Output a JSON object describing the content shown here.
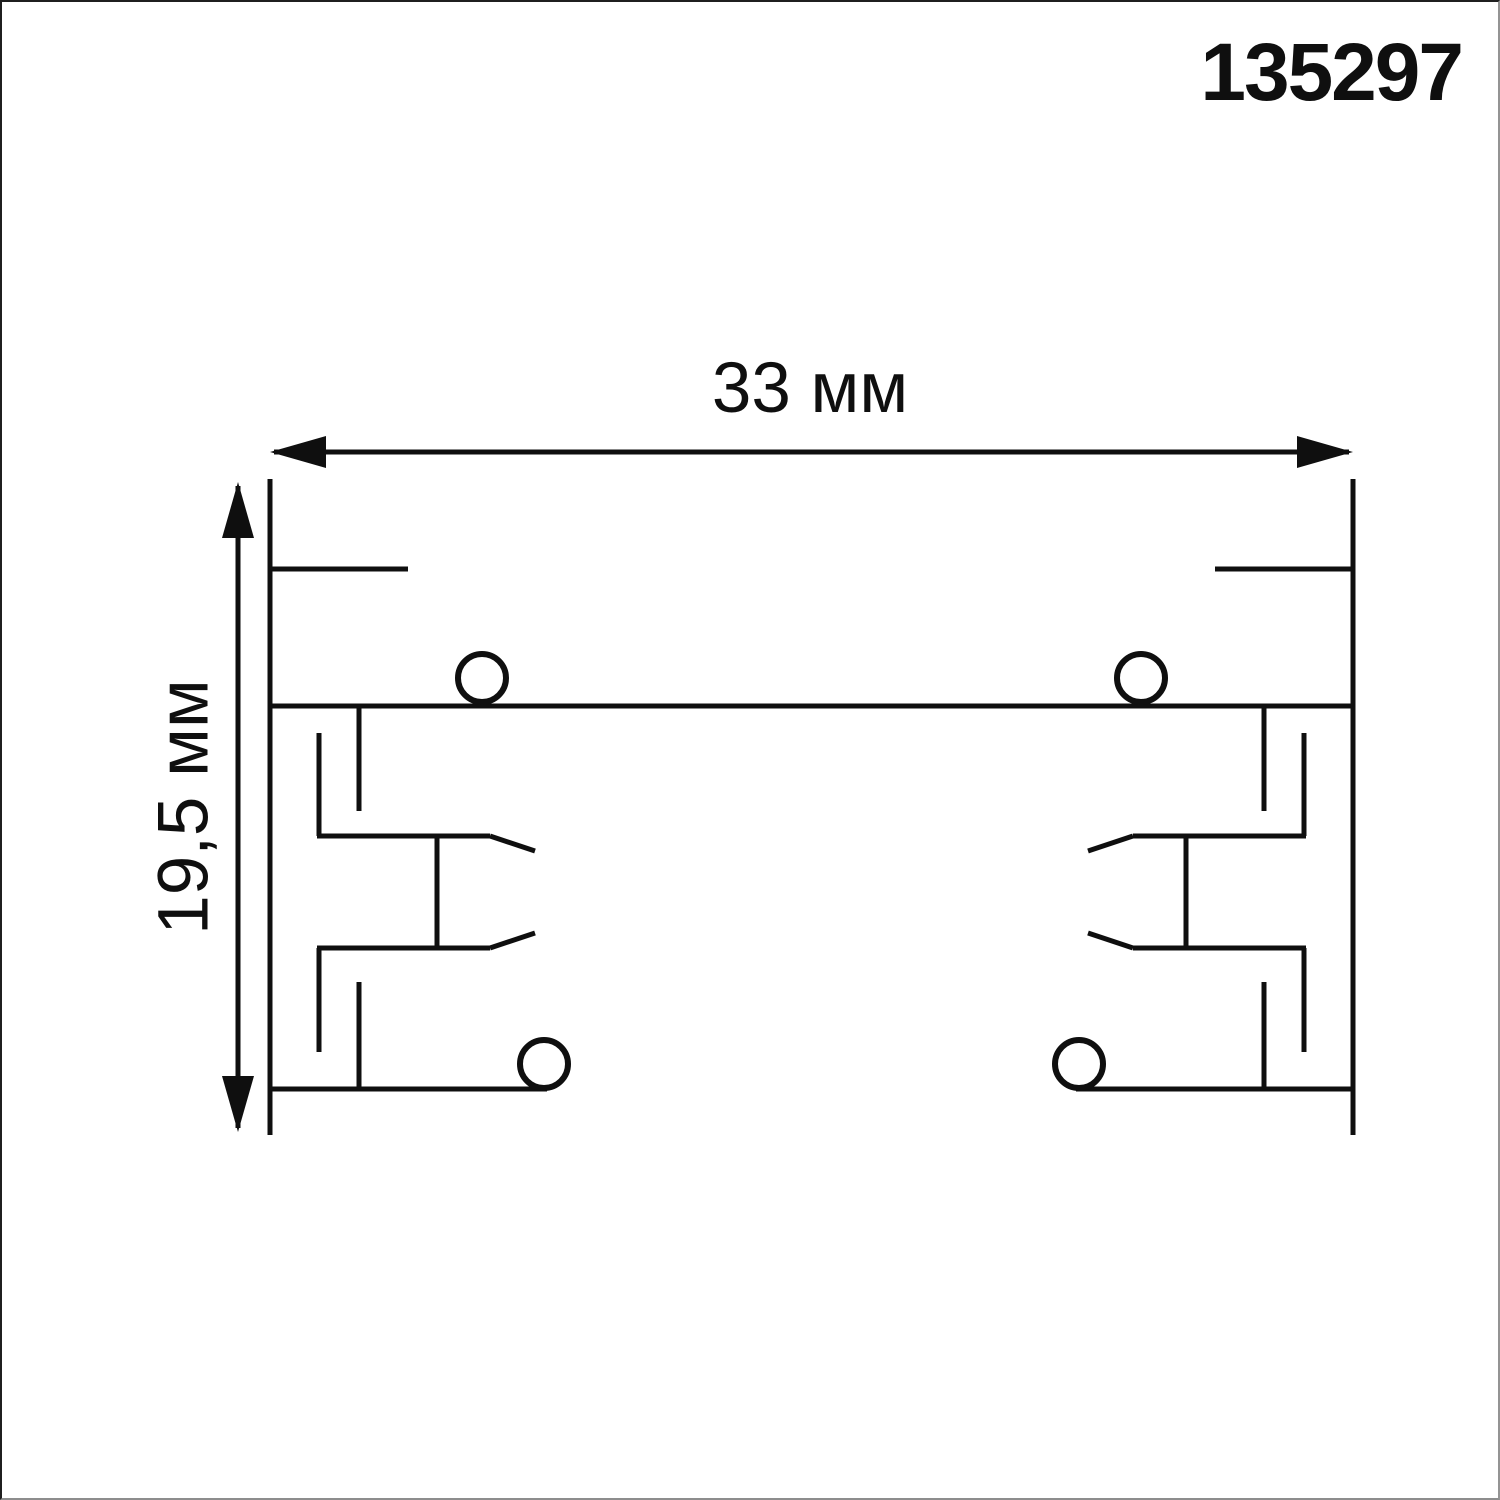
{
  "page": {
    "background": "#ffffff",
    "ink_color": "#0f0f0f",
    "article_number": "135297"
  },
  "dimensions": {
    "width_label": "33 мм",
    "height_label": "19,5 мм"
  },
  "drawing": {
    "view_width": 1500,
    "view_height": 1500,
    "stroke": "#0f0f0f",
    "stroke_width": 5,
    "circle_stroke_width": 6,
    "segments": [
      [
        268,
        477,
        268,
        1133
      ],
      [
        1351,
        477,
        1351,
        1133
      ],
      [
        268,
        704,
        1351,
        704
      ],
      [
        268,
        567,
        406,
        567
      ],
      [
        1213,
        567,
        1351,
        567
      ],
      [
        268,
        1087,
        545,
        1087
      ],
      [
        1074,
        1087,
        1351,
        1087
      ],
      [
        357,
        704,
        357,
        809
      ],
      [
        317,
        731,
        317,
        834
      ],
      [
        315,
        834,
        488,
        834
      ],
      [
        488,
        834,
        533,
        849
      ],
      [
        435,
        834,
        435,
        946
      ],
      [
        315,
        946,
        488,
        946
      ],
      [
        488,
        946,
        533,
        931
      ],
      [
        317,
        946,
        317,
        1050
      ],
      [
        357,
        980,
        357,
        1087
      ],
      [
        1262,
        704,
        1262,
        809
      ],
      [
        1302,
        731,
        1302,
        834
      ],
      [
        1304,
        834,
        1131,
        834
      ],
      [
        1131,
        834,
        1086,
        849
      ],
      [
        1184,
        834,
        1184,
        946
      ],
      [
        1304,
        946,
        1131,
        946
      ],
      [
        1131,
        946,
        1086,
        931
      ],
      [
        1302,
        946,
        1302,
        1050
      ],
      [
        1262,
        980,
        1262,
        1087
      ]
    ],
    "circles": [
      [
        480,
        676,
        24
      ],
      [
        1139,
        676,
        24
      ],
      [
        542,
        1062,
        24
      ],
      [
        1077,
        1062,
        24
      ]
    ],
    "dimension_lines": [
      {
        "type": "h",
        "y": 450,
        "x1": 268,
        "x2": 1351
      },
      {
        "type": "v",
        "x": 236,
        "y1": 480,
        "y2": 1130
      }
    ],
    "arrow_head": {
      "length": 56,
      "half_width": 16
    }
  }
}
